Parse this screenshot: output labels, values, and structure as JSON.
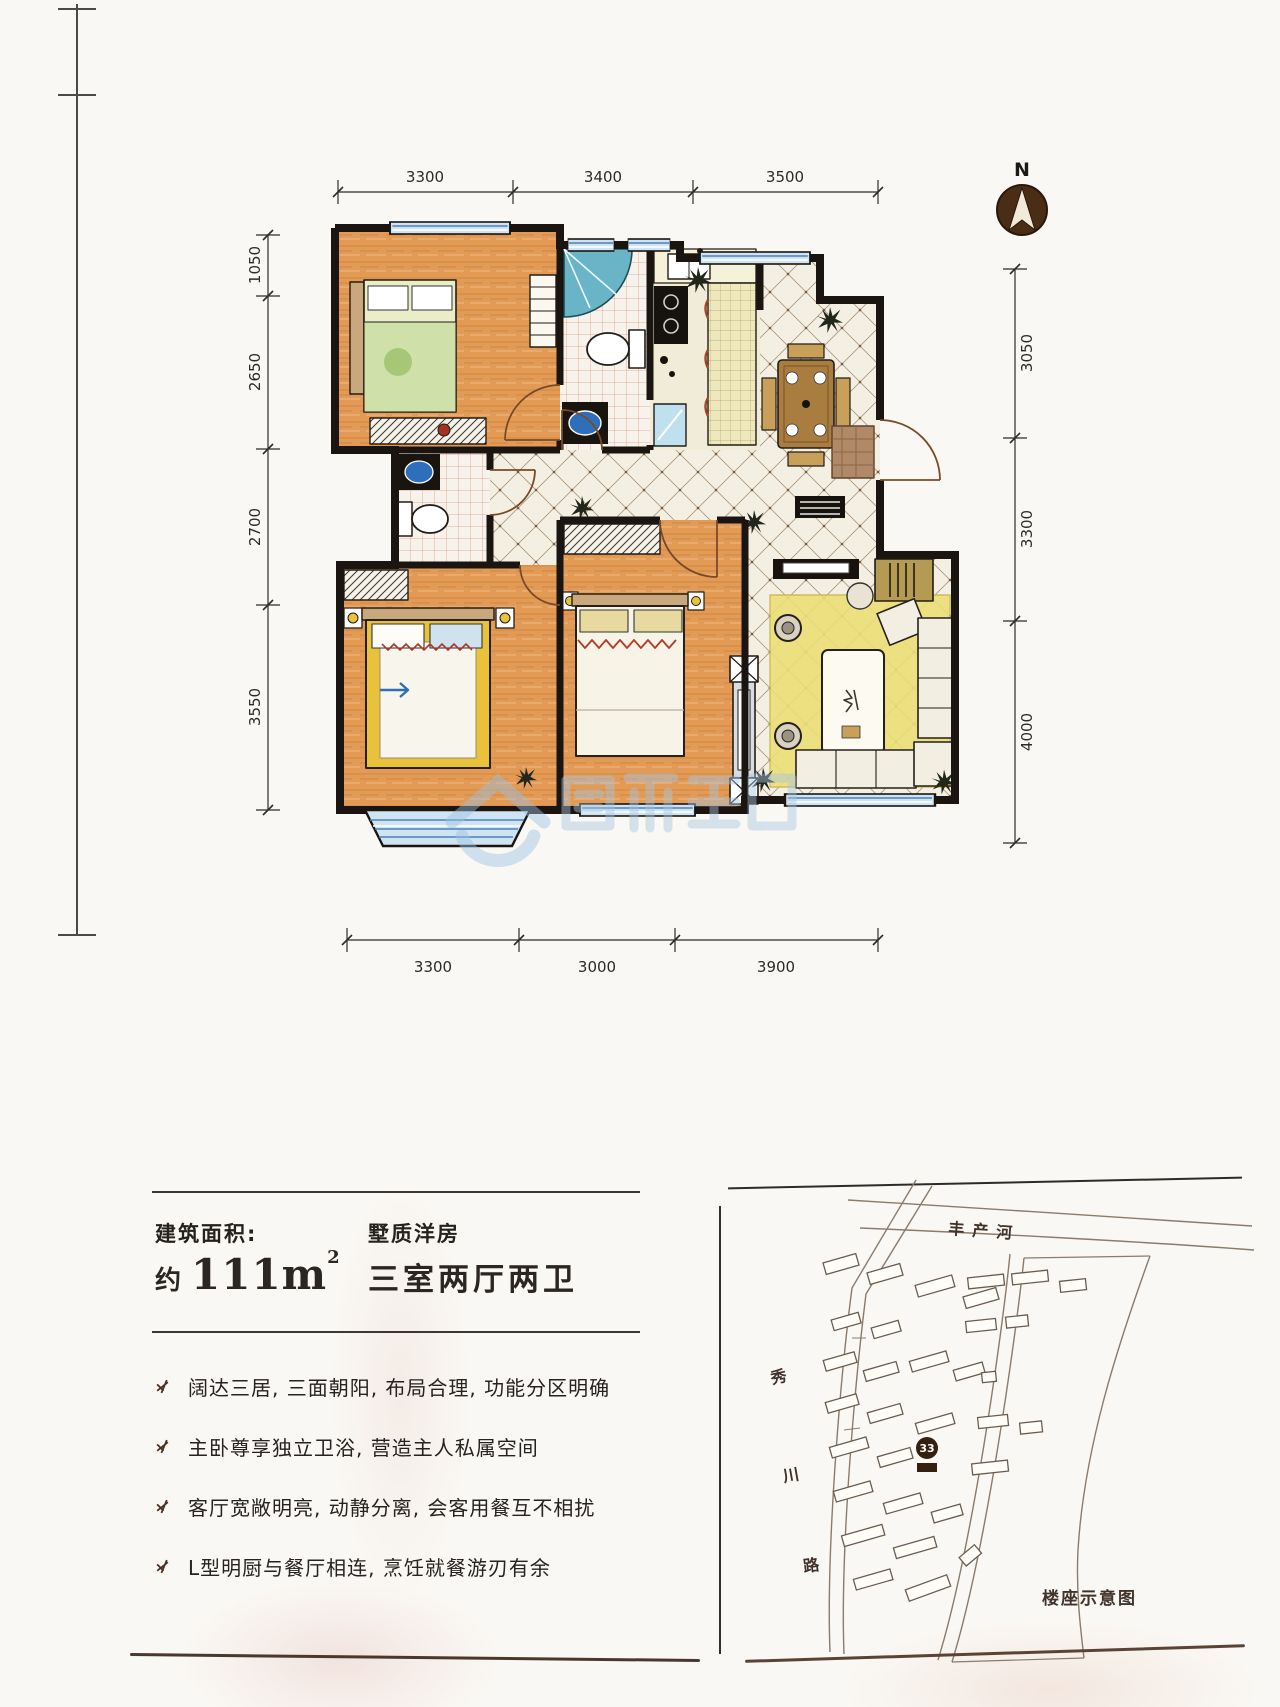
{
  "floor_plan": {
    "compass_label": "N",
    "dim_top": [
      "3300",
      "3400",
      "3500"
    ],
    "dim_left": [
      "1050",
      "2650",
      "2700",
      "3550"
    ],
    "dim_right": [
      "3050",
      "3300",
      "4000"
    ],
    "dim_bottom": [
      "3300",
      "3000",
      "3900"
    ]
  },
  "info": {
    "area_label": "建筑面积:",
    "area_approx": "约",
    "area_number": "111m",
    "area_exponent": "2",
    "series_label": "墅质洋房",
    "layout_label": "三室两厅两卫",
    "features": [
      "阔达三居, 三面朝阳, 布局合理, 功能分区明确",
      "主卧尊享独立卫浴, 营造主人私属空间",
      "客厅宽敞明亮, 动静分离, 会客用餐互不相扰",
      "L型明厨与餐厅相连, 烹饪就餐游刃有余"
    ]
  },
  "site_map": {
    "river_label": "丰产河",
    "road_chars": [
      "秀",
      "川",
      "路"
    ],
    "building_badge": "33",
    "caption": "楼座示意图"
  },
  "accents": {
    "wall": "#1b1511",
    "wood_floor": "#e29a55",
    "tile": "#f4efe3",
    "window_blue": "#cfe4f2",
    "watermark_blue": "#9cc1e4",
    "badge_brown": "#35200f"
  }
}
